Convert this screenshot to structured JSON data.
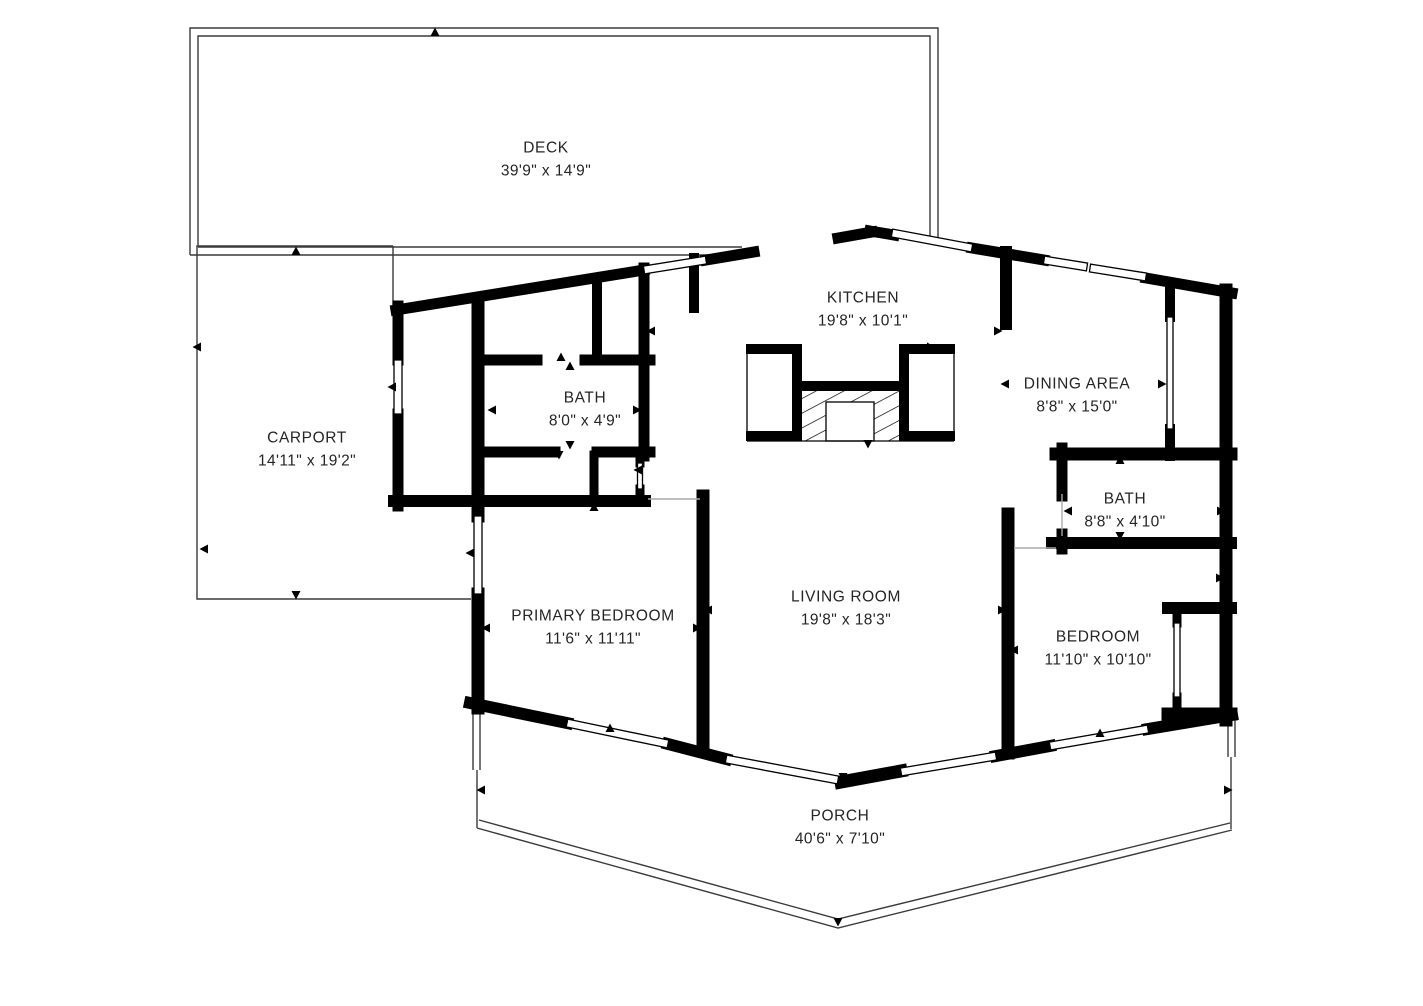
{
  "rooms": {
    "deck": {
      "name": "DECK",
      "dims": "39'9\" x 14'9\""
    },
    "carport": {
      "name": "CARPORT",
      "dims": "14'11\" x 19'2\""
    },
    "kitchen": {
      "name": "KITCHEN",
      "dims": "19'8\" x 10'1\""
    },
    "bath_upper": {
      "name": "BATH",
      "dims": "8'0\" x 4'9\""
    },
    "dining_area": {
      "name": "DINING AREA",
      "dims": "8'8\" x 15'0\""
    },
    "bath_right": {
      "name": "BATH",
      "dims": "8'8\" x 4'10\""
    },
    "living_room": {
      "name": "LIVING ROOM",
      "dims": "19'8\" x 18'3\""
    },
    "primary_bedroom": {
      "name": "PRIMARY BEDROOM",
      "dims": "11'6\" x 11'11\""
    },
    "bedroom": {
      "name": "BEDROOM",
      "dims": "11'10\" x 10'10\""
    },
    "porch": {
      "name": "PORCH",
      "dims": "40'6\" x 7'10\""
    }
  },
  "colors": {
    "wall": "#000000",
    "thin_line": "#3a3a3a",
    "opening_line": "#aaaaaa",
    "label_text": "#252525"
  }
}
